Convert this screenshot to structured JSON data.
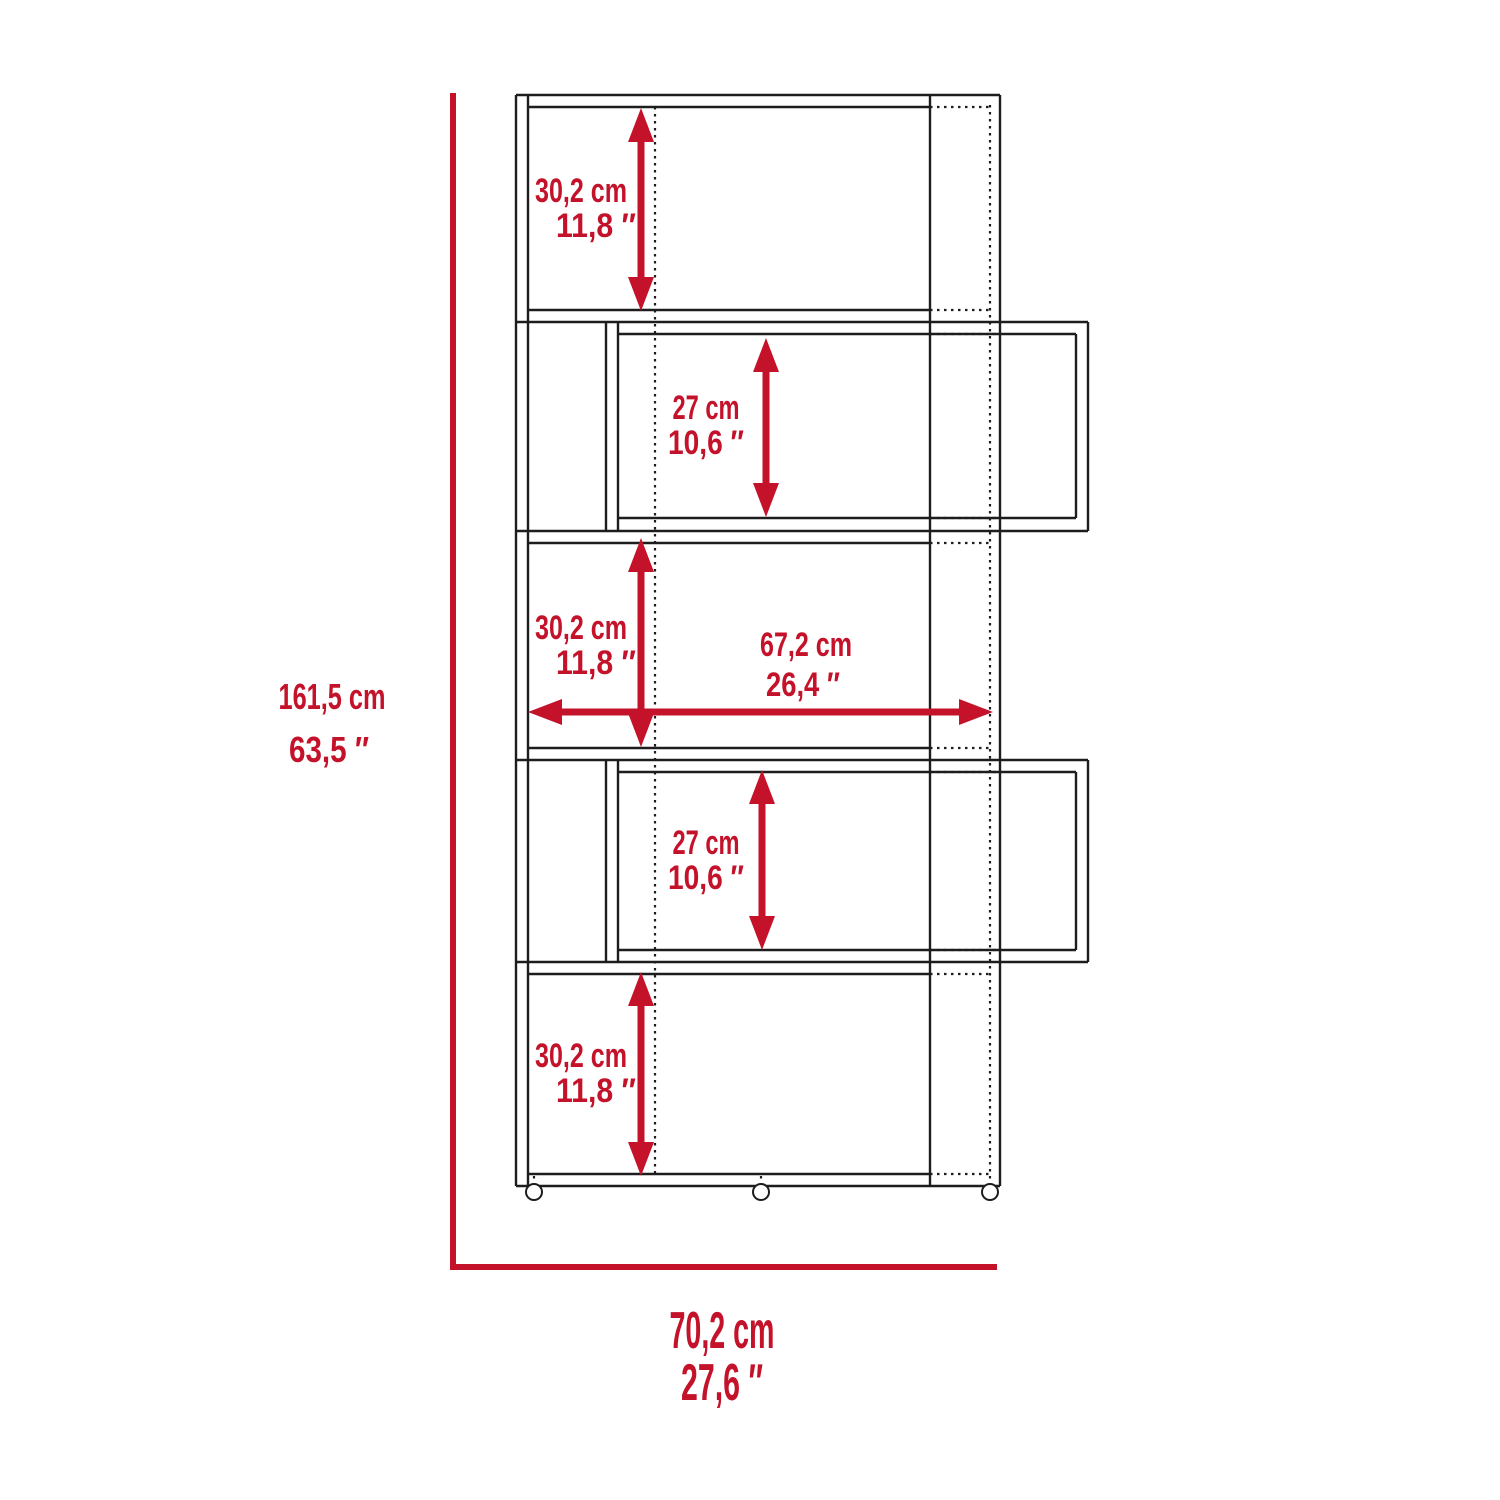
{
  "diagram": {
    "type": "furniture-dimension-drawing",
    "subject": "5-tier zigzag bookcase front elevation with dimensions",
    "colors": {
      "dimension_red": "#c4122a",
      "line_black": "#1d1d1d",
      "background": "#ffffff"
    },
    "overall_height": {
      "cm": "161,5 cm",
      "inches": "63,5 ″"
    },
    "overall_width": {
      "cm": "70,2 cm",
      "inches": "27,6 ″"
    },
    "shelf_interior_width": {
      "cm": "67,2 cm",
      "inches": "26,4 ″"
    },
    "shelves": [
      {
        "name": "shelf-1",
        "cm": "30,2 cm",
        "inches": "11,8 ″"
      },
      {
        "name": "shelf-2",
        "cm": "27 cm",
        "inches": "10,6 ″"
      },
      {
        "name": "shelf-3",
        "cm": "30,2 cm",
        "inches": "11,8 ″"
      },
      {
        "name": "shelf-4",
        "cm": "27 cm",
        "inches": "10,6 ″"
      },
      {
        "name": "shelf-5",
        "cm": "30,2 cm",
        "inches": "11,8 ″"
      }
    ]
  }
}
